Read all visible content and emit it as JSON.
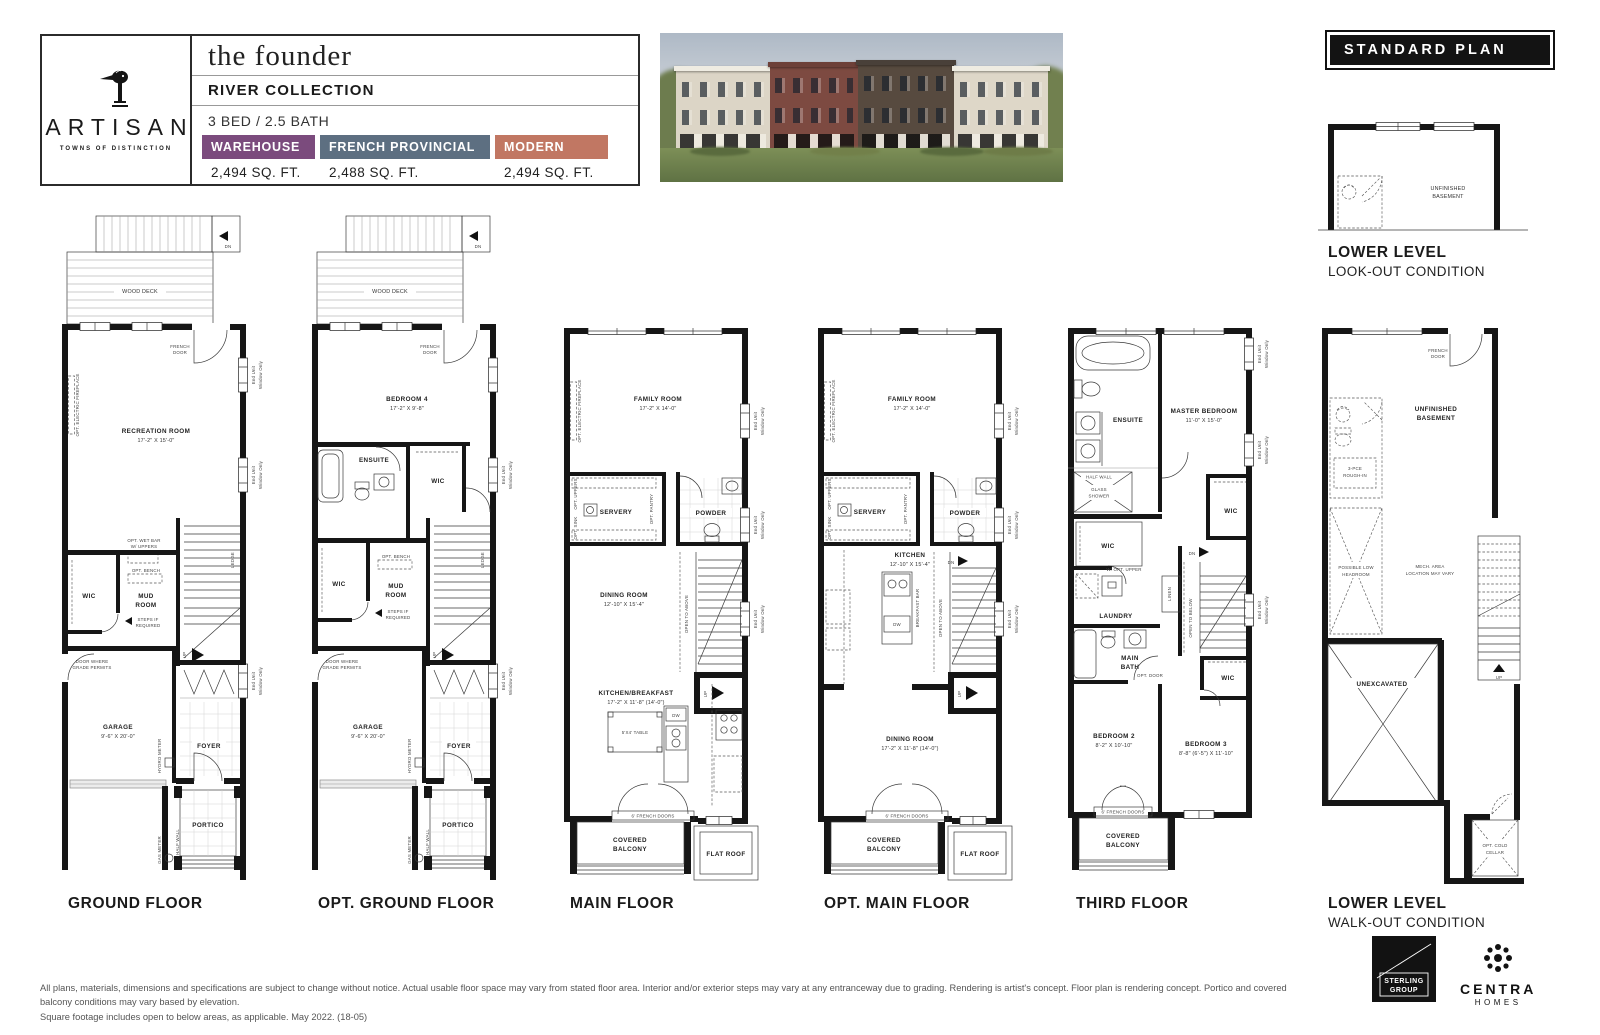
{
  "header": {
    "brand": "ARTISAN",
    "brand_tagline": "TOWNS OF DISTINCTION",
    "plan_name": "the founder",
    "collection": "RIVER COLLECTION",
    "config": "3 BED / 2.5 BATH",
    "elevations": [
      {
        "label": "WAREHOUSE",
        "sqft": "2,494 SQ. FT.",
        "color": "#7b4b7d"
      },
      {
        "label": "FRENCH PROVINCIAL",
        "sqft": "2,488 SQ. FT.",
        "color": "#5d6f81"
      },
      {
        "label": "MODERN",
        "sqft": "2,494 SQ. FT.",
        "color": "#c17763"
      }
    ]
  },
  "banner": {
    "standard_plan": "STANDARD PLAN"
  },
  "common": {
    "end_unit": "End Unit",
    "window_only": "Window Only",
    "wood_deck": "WOOD DECK",
    "dn": "DN",
    "up": "UP",
    "ledge": "LEDGE",
    "french_1": "FRENCH",
    "french_2": "DOOR",
    "opt_fireplace": "OPT. ELECTRIC FIREPLACE",
    "wic": "WIC",
    "opt_bench": "OPT. BENCH",
    "mud_1": "MUD",
    "mud_2": "ROOM",
    "steps_1": "STEPS IF",
    "steps_2": "REQUIRED",
    "grade_1": "DOOR WHERE",
    "grade_2": "GRADE PERMITS",
    "garage": "GARAGE",
    "garage_dim": "9'-6\" X 20'-0\"",
    "foyer": "FOYER",
    "portico": "PORTICO",
    "half_wall": "HALF WALL",
    "hydro": "HYDRO METER",
    "gas": "GAS METER",
    "servery": "SERVERY",
    "opt_pantry": "OPT. PANTRY",
    "opt_sink": "OPT. SINK",
    "opt_uppers": "OPT. UPPERS",
    "powder": "POWDER",
    "dw": "DW",
    "open_above": "OPEN TO ABOVE",
    "open_below": "OPEN TO BELOW",
    "fr_doors": "6' FRENCH DOORS",
    "cov_1": "COVERED",
    "cov_2": "BALCONY",
    "flat_roof": "FLAT ROOF",
    "unf_1": "UNFINISHED",
    "unf_2": "BASEMENT",
    "ensuite": "ENSUITE",
    "table": "5'X4' TABLE"
  },
  "plans": {
    "ground": {
      "label": "GROUND FLOOR",
      "room": "RECREATION ROOM",
      "room_dim": "17'-2\" X 15'-0\"",
      "wetbar_1": "OPT. WET BAR",
      "wetbar_2": "W/ UPPERS"
    },
    "opt_ground": {
      "label": "OPT. GROUND FLOOR",
      "room": "BEDROOM 4",
      "room_dim": "17'-2\" X 9'-8\""
    },
    "main": {
      "label": "MAIN FLOOR",
      "family": "FAMILY ROOM",
      "family_dim": "17'-2\" X 14'-0\"",
      "dining": "DINING ROOM",
      "dining_dim": "12'-10\" X 15'-4\"",
      "kitchen": "KITCHEN/BREAKFAST",
      "kitchen_dim": "17'-2\" X 11'-8\" (14'-0\")"
    },
    "opt_main": {
      "label": "OPT. MAIN FLOOR",
      "kitchen": "KITCHEN",
      "kitchen_dim": "12'-10\" X 15'-4\"",
      "bar": "BREAKFAST BAR",
      "dining": "DINING ROOM",
      "dining_dim": "17'-2\" X 11'-8\" (14'-0\")"
    },
    "third": {
      "label": "THIRD FLOOR",
      "master": "MASTER BEDROOM",
      "master_dim": "11'-0\" X 15'-0\"",
      "glass_1": "GLASS",
      "glass_2": "SHOWER",
      "linen": "LINEN",
      "laundry": "LAUNDRY",
      "opt_upper": "W/ OPT. UPPER",
      "bath_1": "MAIN",
      "bath_2": "BATH",
      "opt_door": "OPT. DOOR",
      "bed2": "BEDROOM 2",
      "bed2_dim": "8'-2\" X 10'-10\"",
      "bed3": "BEDROOM 3",
      "bed3_dim": "8'-8\" (6'-5\") X 11'-10\""
    },
    "lower_walkout": {
      "label_1": "LOWER LEVEL",
      "label_2": "WALK-OUT CONDITION",
      "rough_1": "3-PCE",
      "rough_2": "ROUGH-IN",
      "head_1": "POSSIBLE LOW",
      "head_2": "HEADROOM",
      "mech_1": "MECH. AREA",
      "mech_2": "LOCATION MAY VARY",
      "unex": "UNEXCAVATED",
      "cold_1": "OPT. COLD",
      "cold_2": "CELLAR"
    },
    "lower_lookout": {
      "label_1": "LOWER LEVEL",
      "label_2": "LOOK-OUT CONDITION"
    }
  },
  "footer": {
    "disclaimer_1": "All plans, materials, dimensions and specifications are subject to change without notice. Actual usable floor space may vary from stated floor area. Interior and/or exterior steps may vary at any entranceway due to grading. Rendering is artist's concept. Floor plan is rendering concept. Portico and covered balcony conditions may vary based by elevation.",
    "disclaimer_2": "Square footage includes open to below areas, as applicable. May 2022. (18-05)",
    "sterling_1": "STERLING",
    "sterling_2": "GROUP",
    "centra_1": "CENTRA",
    "centra_2": "HOMES"
  }
}
